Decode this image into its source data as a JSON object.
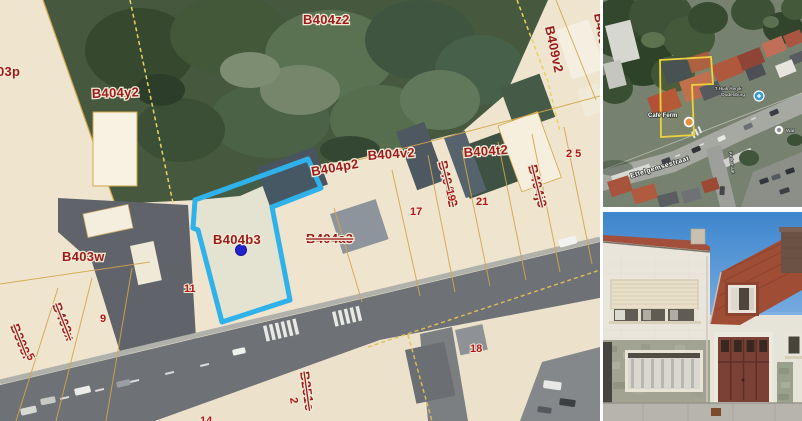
{
  "map": {
    "selected_parcel": "B404b3",
    "labels": [
      {
        "text": "03p"
      },
      {
        "text": "B404y2"
      },
      {
        "text": "B404z2"
      },
      {
        "text": "B409v2"
      },
      {
        "text": "B409c"
      },
      {
        "text": "B404p2"
      },
      {
        "text": "B404v2"
      },
      {
        "text": "B404t2"
      },
      {
        "text": "B404s2",
        "struck": true
      },
      {
        "text": "B404j3",
        "struck": true
      },
      {
        "text": "B404b3"
      },
      {
        "text": "B404a3",
        "struck": true
      },
      {
        "text": "B403w"
      },
      {
        "text": "B403x",
        "struck": true
      },
      {
        "text": "B398f",
        "struck": true
      },
      {
        "text": "B251e",
        "struck": true
      }
    ],
    "house_numbers": [
      {
        "text": "5"
      },
      {
        "text": "9"
      },
      {
        "text": "11"
      },
      {
        "text": "14"
      },
      {
        "text": "17"
      },
      {
        "text": "19"
      },
      {
        "text": "21"
      },
      {
        "text": "25"
      },
      {
        "text": "18"
      },
      {
        "text": "2"
      }
    ],
    "colors": {
      "parcel_highlight": "#2fb1ea",
      "selection_dot": "#2323cc",
      "label_red": "#9b1b1b",
      "boundary_orange": "#d2a54a",
      "dashed_yellow": "#ecd05f"
    }
  },
  "aerial": {
    "street_label": "Ettelgemsestraat",
    "side_street_label": "Kerkstraat",
    "poi_cafe": "Café Ferm",
    "poi_line1": "'t Huis Aeryk",
    "poi_line2": "Oudenburg",
    "poi_partial": "Wal",
    "parcel_outline_color": "#ecd23c"
  },
  "photo": {
    "garage_color": "#7c4136",
    "roof_color": "#a04d35"
  }
}
